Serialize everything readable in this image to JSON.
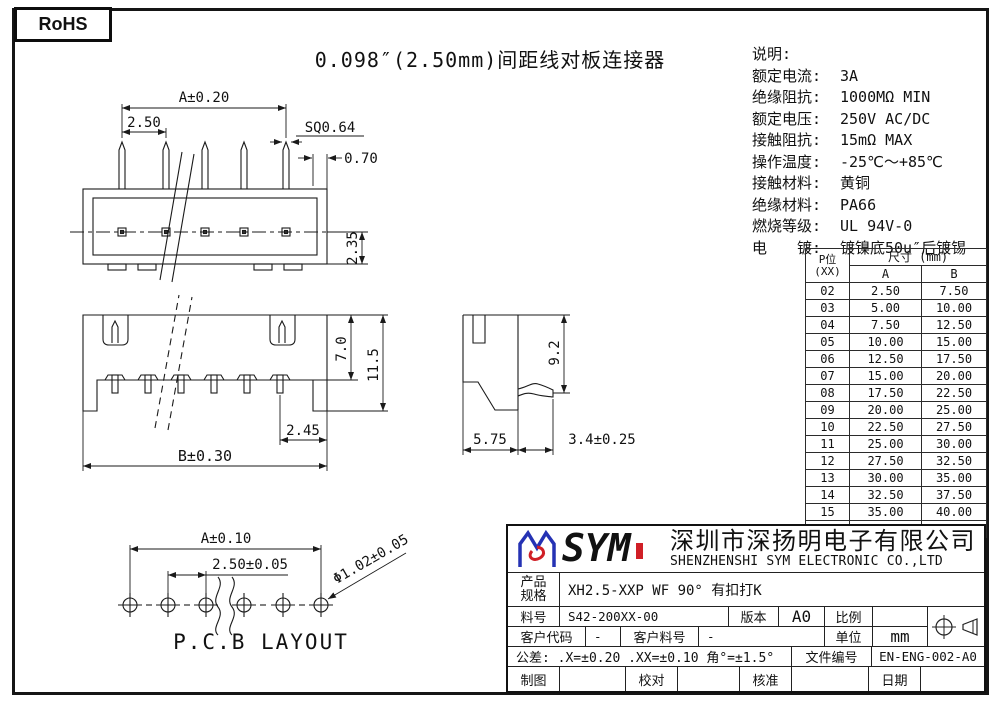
{
  "page": {
    "rohs_label": "RoHS",
    "title": "0.098″(2.50mm)间距线对板连接器"
  },
  "specs": {
    "heading": "说明:",
    "items": [
      {
        "label": "额定电流:",
        "value": "3A"
      },
      {
        "label": "绝缘阻抗:",
        "value": "1000MΩ MIN"
      },
      {
        "label": "额定电压:",
        "value": "250V AC/DC"
      },
      {
        "label": "接触阻抗:",
        "value": "15mΩ MAX"
      },
      {
        "label": "操作温度:",
        "value": "-25℃～+85℃"
      },
      {
        "label": "接触材料:",
        "value": "黄铜"
      },
      {
        "label": "绝缘材料:",
        "value": "PA66"
      },
      {
        "label": "燃烧等级:",
        "value": "UL 94V-0"
      },
      {
        "label": "电　　镀:",
        "value": "镀镍底50u″后镀锡"
      }
    ]
  },
  "dim_table": {
    "col1_line1": "P位",
    "col1_line2": "(XX)",
    "size_header": "尺寸 (mm)",
    "col_a": "A",
    "col_b": "B",
    "rows": [
      [
        "02",
        "2.50",
        "7.50"
      ],
      [
        "03",
        "5.00",
        "10.00"
      ],
      [
        "04",
        "7.50",
        "12.50"
      ],
      [
        "05",
        "10.00",
        "15.00"
      ],
      [
        "06",
        "12.50",
        "17.50"
      ],
      [
        "07",
        "15.00",
        "20.00"
      ],
      [
        "08",
        "17.50",
        "22.50"
      ],
      [
        "09",
        "20.00",
        "25.00"
      ],
      [
        "10",
        "22.50",
        "27.50"
      ],
      [
        "11",
        "25.00",
        "30.00"
      ],
      [
        "12",
        "27.50",
        "32.50"
      ],
      [
        "13",
        "30.00",
        "35.00"
      ],
      [
        "14",
        "32.50",
        "37.50"
      ],
      [
        "15",
        "35.00",
        "40.00"
      ],
      [
        "20",
        "47.50",
        "52.50"
      ]
    ]
  },
  "drawings": {
    "top_view": {
      "dim_a": "A±0.20",
      "dim_pitch": "2.50",
      "dim_sq": "SQ0.64",
      "dim_offset": "0.70",
      "dim_height": "2.35"
    },
    "front_view": {
      "dim_inner_h": "7.0",
      "dim_total_h": "11.5",
      "dim_leg": "2.45",
      "dim_b": "B±0.30"
    },
    "side_view": {
      "dim_h": "9.2",
      "dim_w": "5.75",
      "dim_pin": "3.4±0.25"
    },
    "pcb_layout": {
      "dim_a": "A±0.10",
      "dim_pitch": "2.50±0.05",
      "dim_hole": "Φ1.02±0.05",
      "caption": "P.C.B LAYOUT"
    }
  },
  "title_block": {
    "logo_text": "SYM",
    "company_cn": "深圳市深扬明电子有限公司",
    "company_en": "SHENZHENSHI SYM ELECTRONIC CO.,LTD",
    "product_label_l1": "产品",
    "product_label_l2": "规格",
    "product_value": "XH2.5-XXP WF 90°  有扣打K",
    "part_no_label": "料号",
    "part_no_value": "S42-200XX-00",
    "version_label": "版本",
    "version_value": "A0",
    "scale_label": "比例",
    "scale_value": "",
    "customer_code_label": "客户代码",
    "customer_code_value": "-",
    "customer_part_label": "客户料号",
    "customer_part_value": "-",
    "unit_label": "单位",
    "unit_value": "mm",
    "tolerance_text": "公差: .X=±0.20  .XX=±0.10  角°=±1.5°",
    "doc_no_label": "文件编号",
    "doc_no_value": "EN-ENG-002-A0",
    "draw_label": "制图",
    "check_label": "校对",
    "approve_label": "核准",
    "date_label": "日期"
  }
}
